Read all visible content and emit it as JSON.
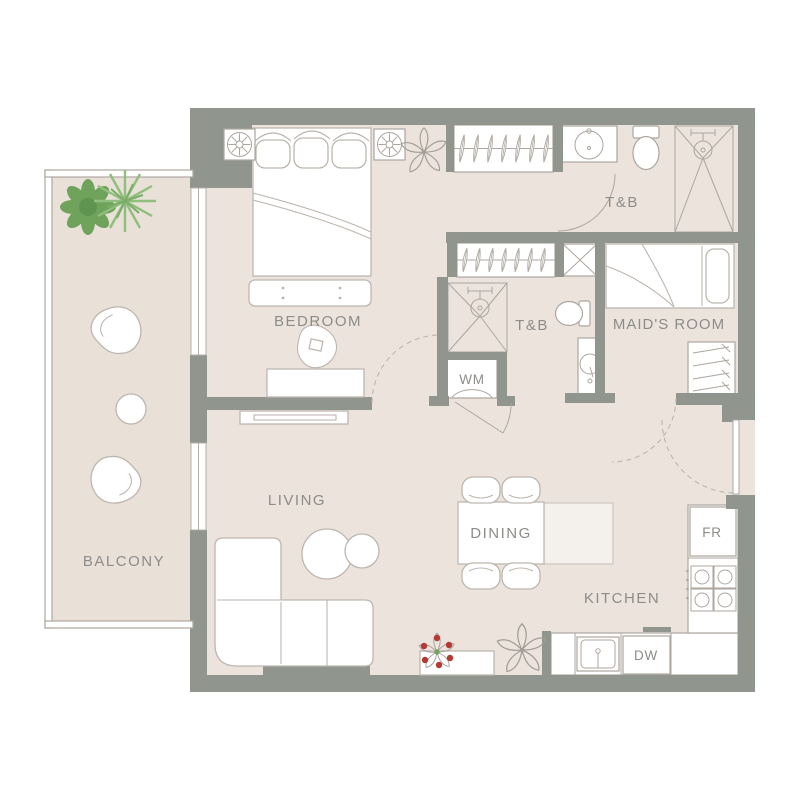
{
  "plan": {
    "type": "apartment-floor-plan",
    "rooms": {
      "bedroom": {
        "label": "BEDROOM"
      },
      "living": {
        "label": "LIVING"
      },
      "balcony": {
        "label": "BALCONY"
      },
      "dining": {
        "label": "DINING"
      },
      "kitchen": {
        "label": "KITCHEN"
      },
      "maids_room": {
        "label": "MAID'S ROOM"
      },
      "bath_main": {
        "label": "T&B"
      },
      "bath_second": {
        "label": "T&B"
      }
    },
    "appliances": {
      "washing_machine": {
        "label": "WM"
      },
      "fridge": {
        "label": "FR"
      },
      "dishwasher": {
        "label": "DW"
      }
    },
    "colors": {
      "wall": "#90958D",
      "floor": "#ECE3DD",
      "balcony_floor": "#E9E0D8",
      "furniture_outline": "#BDB6AF",
      "label_text": "#8C8C89",
      "plant_green_dark": "#6FA35C",
      "plant_green_light": "#8FBE7D",
      "flower_red": "#B23A33",
      "sketch_gray": "#A39D96"
    },
    "furniture_icons": [
      "double-bed",
      "bed-bench",
      "nightstand-lamp",
      "wardrobe-hangers",
      "desk",
      "desk-chair",
      "tv-console",
      "sofa-l-shaped",
      "coffee-table",
      "console-table",
      "dining-table",
      "dining-chair",
      "kitchen-sink",
      "dishwasher",
      "stove-burners",
      "fridge",
      "washing-machine",
      "shaft",
      "shower",
      "toilet",
      "washbasin",
      "single-bed",
      "closet-shelves",
      "balcony-chair",
      "round-table",
      "bush-plant",
      "palm-plant",
      "sketch-plant",
      "flower-pot"
    ]
  }
}
